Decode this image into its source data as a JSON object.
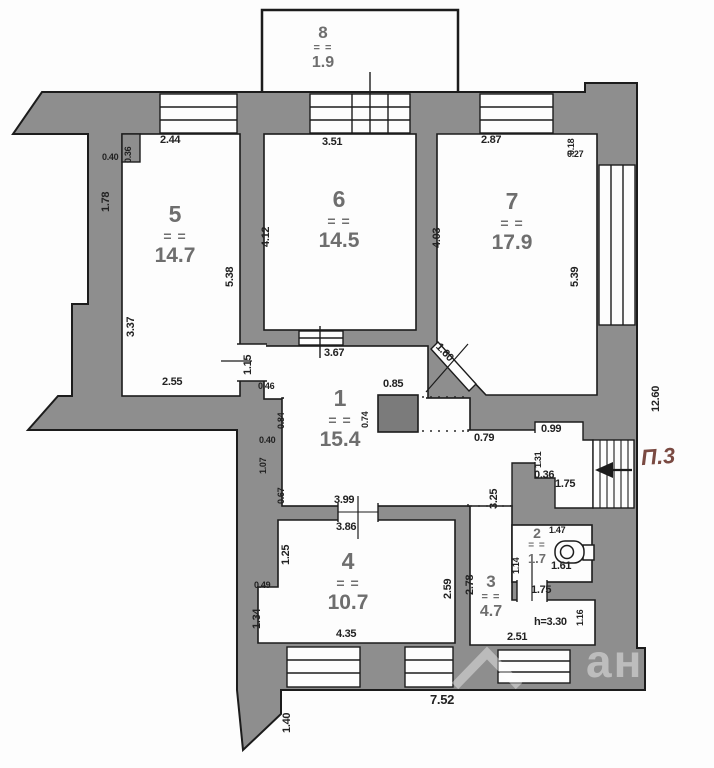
{
  "plan_title": "apartment-floor-plan",
  "colors": {
    "wall": "#8e8e8e",
    "line": "#1c1c1c",
    "paper": "#fdfdfd",
    "room_label": "#6e6e6e",
    "exit_label": "#7a4a42",
    "column": "#7b7b7b"
  },
  "marks": {
    "eq": "= ="
  },
  "rooms": {
    "hall": {
      "num": "1",
      "area": "15.4"
    },
    "wc": {
      "num": "2",
      "area": "1.7"
    },
    "room3": {
      "num": "3",
      "area": "4.7"
    },
    "room4": {
      "num": "4",
      "area": "10.7"
    },
    "room5": {
      "num": "5",
      "area": "14.7"
    },
    "room6": {
      "num": "6",
      "area": "14.5"
    },
    "room7": {
      "num": "7",
      "area": "17.9"
    },
    "balcony": {
      "num": "8",
      "area": "1.9"
    }
  },
  "dims": {
    "d244": "2.44",
    "d351": "3.51",
    "d287": "2.87",
    "d018": "0.18",
    "d027": "0.27",
    "d040a": "0.40",
    "d036a": "0.36",
    "d178": "1.78",
    "d337": "3.37",
    "d538": "5.38",
    "d412": "4.12",
    "d403": "4.03",
    "d539": "5.39",
    "d255": "2.55",
    "d367": "3.67",
    "d115": "1.15",
    "d160": "1.60",
    "d046": "0.46",
    "d084": "0.84",
    "d040b": "0.40",
    "d107": "1.07",
    "d067": "0.67",
    "d085": "0.85",
    "d074": "0.74",
    "d079": "0.79",
    "d099": "0.99",
    "d131": "1.31",
    "d036b": "0.36",
    "d175a": "1.75",
    "d325": "3.25",
    "d399": "3.99",
    "d386": "3.86",
    "d125": "1.25",
    "d049": "0.49",
    "d134": "1.34",
    "d435": "4.35",
    "d259": "2.59",
    "d278": "2.78",
    "d251": "2.51",
    "d116": "1.16",
    "d175b": "1.75",
    "d147": "1.47",
    "d114": "1.14",
    "d161": "1.61",
    "d752": "7.52",
    "d140": "1.40",
    "d1260": "12.60"
  },
  "notes": {
    "stair_exit": "П.3",
    "ceiling_height": "h=3.30"
  },
  "watermark": {
    "text": "ан"
  }
}
